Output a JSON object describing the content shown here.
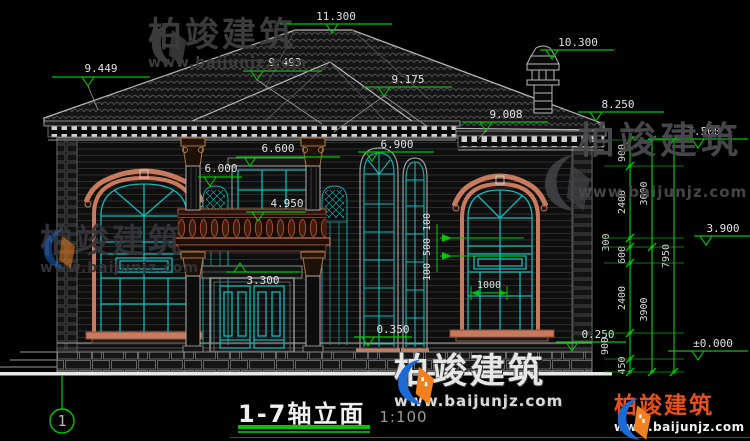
{
  "drawing": {
    "title": "1-7轴立面",
    "scale": "1:100",
    "axis_bubble": "1",
    "levels": [
      "11.300",
      "10.300",
      "9.449",
      "9.493",
      "9.175",
      "9.008",
      "8.250",
      "7.500",
      "6.900",
      "6.600",
      "6.000",
      "4.950",
      "3.300",
      "3.900",
      "0.350",
      "0.250",
      "±0.000"
    ],
    "dim_chains": {
      "right_inner": [
        "900",
        "2400",
        "300",
        "600",
        "2400",
        "900",
        "450"
      ],
      "right_mid": [
        "3600",
        "3900"
      ],
      "right_total": [
        "7950"
      ],
      "window_band": [
        "100",
        "500",
        "100"
      ],
      "window_width": "1000"
    }
  },
  "watermark": {
    "brand": "柏竣建筑",
    "url": "www.baijunjz.com"
  },
  "colors": {
    "background": "#000000",
    "dimension_green": "#00c400",
    "drawing_white": "#d8d8d8",
    "window_teal": "#12b4b4",
    "trim_salmon": "#c87a5e",
    "capital_tan": "#a87848",
    "balustrade_maroon": "#7a2e1a",
    "brand_red": "#e8501e",
    "brand_blue": "#1e6ad4",
    "brand_orange": "#f08020"
  }
}
